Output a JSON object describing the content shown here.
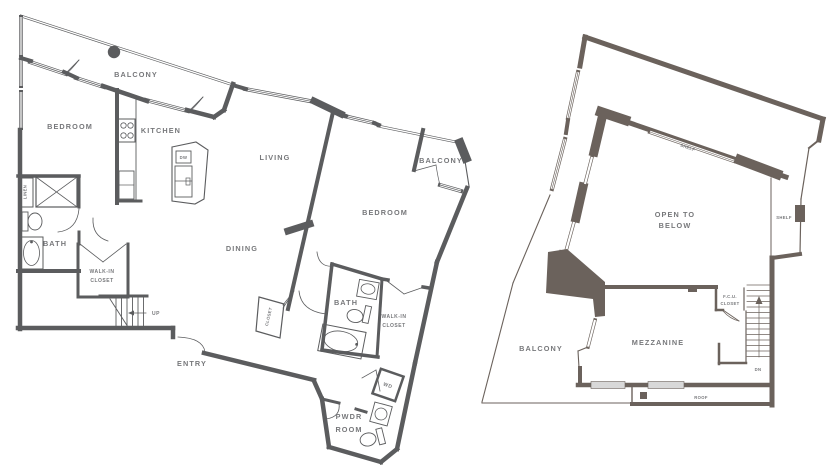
{
  "colors": {
    "left_plan_wall": "#5b5c5e",
    "right_plan_wall": "#6b625c",
    "label_text": "#77787b",
    "window_slab": "#d8d8d8",
    "background": "#ffffff"
  },
  "left_plan": {
    "name": "lower-level-floor-plan",
    "labels": {
      "balcony_top": "BALCONY",
      "bedroom_left": "BEDROOM",
      "kitchen": "KITCHEN",
      "dw": "DW",
      "living": "LIVING",
      "dining": "DINING",
      "balcony_right": "BALCONY",
      "bedroom_right": "BEDROOM",
      "linen": "LINEN",
      "bath_left": "BATH",
      "walk_in_left_line1": "WALK-IN",
      "walk_in_left_line2": "CLOSET",
      "up": "UP",
      "entry": "ENTRY",
      "closet": "CLOSET",
      "bath_right": "BATH",
      "walk_in_right_line1": "WALK-IN",
      "walk_in_right_line2": "CLOSET",
      "wd": "WD",
      "pwdr_line1": "PWDR",
      "pwdr_line2": "ROOM"
    }
  },
  "right_plan": {
    "name": "mezzanine-level-floor-plan",
    "labels": {
      "shelf_top": "SHELF",
      "shelf_right": "SHELF",
      "open_line1": "OPEN TO",
      "open_line2": "BELOW",
      "fcu_line1": "F.C.U.",
      "fcu_line2": "CLOSET",
      "balcony": "BALCONY",
      "mezzanine": "MEZZANINE",
      "dn": "DN",
      "roof": "ROOF"
    }
  }
}
